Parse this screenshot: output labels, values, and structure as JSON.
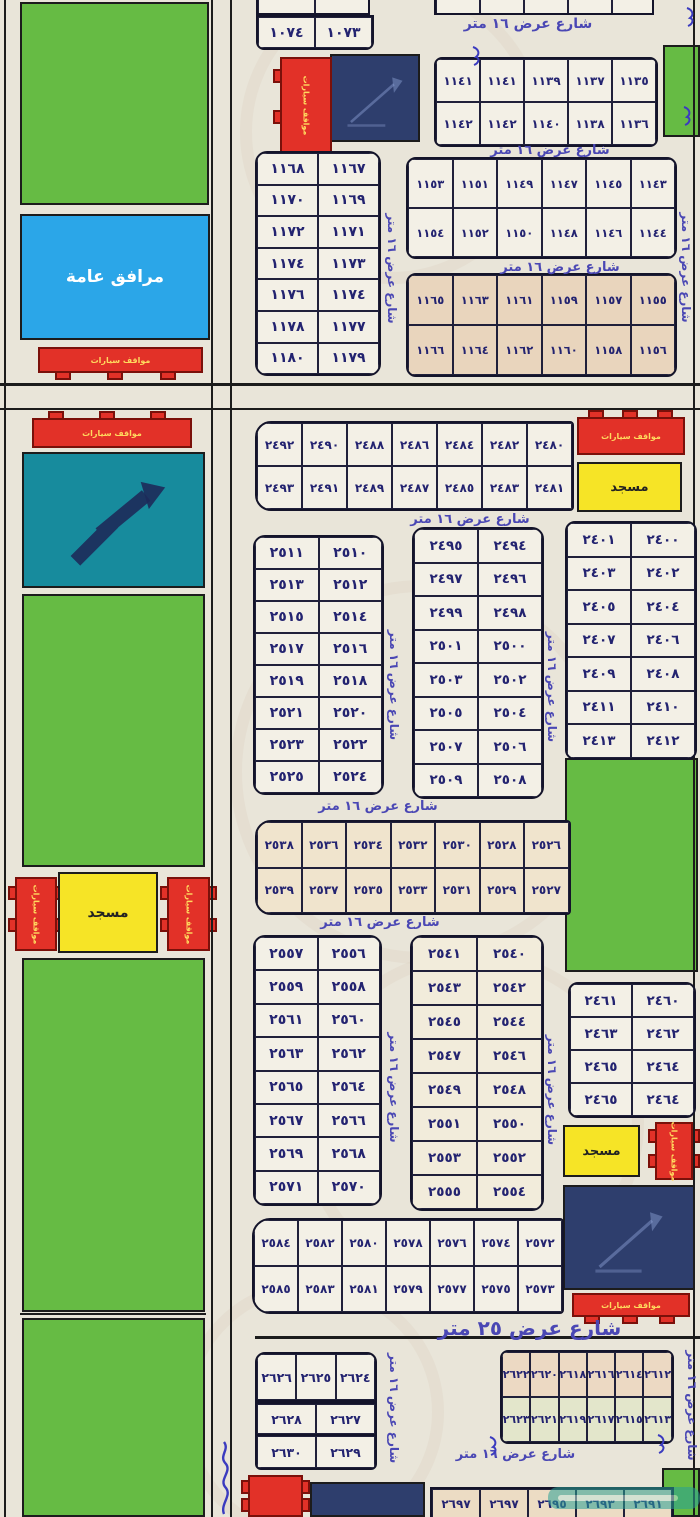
{
  "labels": {
    "street16": "شارع عرض ١٦ متر",
    "street25": "شارع عرض ٢٥ متر",
    "mosque": "مسجد",
    "facilities": "مرافق عامة",
    "parking": "مواقف سيارات"
  },
  "colors": {
    "park_green": "#66bb44",
    "facilities_blue": "#2ba6e8",
    "utility_teal": "#178b9d",
    "reserved_navy": "#2e3e6d",
    "mosque_yellow": "#f6e426",
    "parking_red": "#e23128",
    "street_text": "#4a47b4",
    "plot_number_text": "#232370",
    "paper": "#e9e5d9"
  },
  "tables": {
    "t1073": {
      "rows": [
        [
          "١٠٧٤",
          "١٠٧٣"
        ]
      ]
    },
    "t1135": {
      "rows": [
        [
          "١١٤١",
          "١١٤١",
          "١١٣٩",
          "١١٣٧",
          "١١٣٥"
        ],
        [
          "١١٤٢",
          "١١٤٢",
          "١١٤٠",
          "١١٣٨",
          "١١٣٦"
        ]
      ]
    },
    "t1167": {
      "rows": [
        [
          "١١٦٨",
          "١١٦٧"
        ],
        [
          "١١٧٠",
          "١١٦٩"
        ],
        [
          "١١٧٢",
          "١١٧١"
        ],
        [
          "١١٧٤",
          "١١٧٣"
        ],
        [
          "١١٧٦",
          "١١٧٤"
        ],
        [
          "١١٧٨",
          "١١٧٧"
        ],
        [
          "١١٨٠",
          "١١٧٩"
        ]
      ]
    },
    "t1143": {
      "rows": [
        [
          "١١٥٣",
          "١١٥١",
          "١١٤٩",
          "١١٤٧",
          "١١٤٥",
          "١١٤٣"
        ],
        [
          "١١٥٤",
          "١١٥٢",
          "١١٥٠",
          "١١٤٨",
          "١١٤٦",
          "١١٤٤"
        ]
      ]
    },
    "t1155": {
      "rows": [
        [
          "١١٦٥",
          "١١٦٣",
          "١١٦١",
          "١١٥٩",
          "١١٥٧",
          "١١٥٥"
        ],
        [
          "١١٦٦",
          "١١٦٤",
          "١١٦٢",
          "١١٦٠",
          "١١٥٨",
          "١١٥٦"
        ]
      ]
    },
    "t2480": {
      "rows": [
        [
          "٢٤٩٢",
          "٢٤٩٠",
          "٢٤٨٨",
          "٢٤٨٦",
          "٢٤٨٤",
          "٢٤٨٢",
          "٢٤٨٠"
        ],
        [
          "٢٤٩٣",
          "٢٤٩١",
          "٢٤٨٩",
          "٢٤٨٧",
          "٢٤٨٥",
          "٢٤٨٣",
          "٢٤٨١"
        ]
      ]
    },
    "t2510": {
      "rows": [
        [
          "٢٥١١",
          "٢٥١٠"
        ],
        [
          "٢٥١٣",
          "٢٥١٢"
        ],
        [
          "٢٥١٥",
          "٢٥١٤"
        ],
        [
          "٢٥١٧",
          "٢٥١٦"
        ],
        [
          "٢٥١٩",
          "٢٥١٨"
        ],
        [
          "٢٥٢١",
          "٢٥٢٠"
        ],
        [
          "٢٥٢٣",
          "٢٥٢٢"
        ],
        [
          "٢٥٢٥",
          "٢٥٢٤"
        ]
      ]
    },
    "t2494": {
      "rows": [
        [
          "٢٤٩٥",
          "٢٤٩٤"
        ],
        [
          "٢٤٩٧",
          "٢٤٩٦"
        ],
        [
          "٢٤٩٩",
          "٢٤٩٨"
        ],
        [
          "٢٥٠١",
          "٢٥٠٠"
        ],
        [
          "٢٥٠٣",
          "٢٥٠٢"
        ],
        [
          "٢٥٠٥",
          "٢٥٠٤"
        ],
        [
          "٢٥٠٧",
          "٢٥٠٦"
        ],
        [
          "٢٥٠٩",
          "٢٥٠٨"
        ]
      ]
    },
    "t2400": {
      "rows": [
        [
          "٢٤٠١",
          "٢٤٠٠"
        ],
        [
          "٢٤٠٣",
          "٢٤٠٢"
        ],
        [
          "٢٤٠٥",
          "٢٤٠٤"
        ],
        [
          "٢٤٠٧",
          "٢٤٠٦"
        ],
        [
          "٢٤٠٩",
          "٢٤٠٨"
        ],
        [
          "٢٤١١",
          "٢٤١٠"
        ],
        [
          "٢٤١٣",
          "٢٤١٢"
        ]
      ]
    },
    "t2526": {
      "rows": [
        [
          "٢٥٣٨",
          "٢٥٣٦",
          "٢٥٣٤",
          "٢٥٣٢",
          "٢٥٣٠",
          "٢٥٢٨",
          "٢٥٢٦"
        ],
        [
          "٢٥٣٩",
          "٢٥٣٧",
          "٢٥٣٥",
          "٢٥٣٣",
          "٢٥٣١",
          "٢٥٢٩",
          "٢٥٢٧"
        ]
      ]
    },
    "t2556": {
      "rows": [
        [
          "٢٥٥٧",
          "٢٥٥٦"
        ],
        [
          "٢٥٥٩",
          "٢٥٥٨"
        ],
        [
          "٢٥٦١",
          "٢٥٦٠"
        ],
        [
          "٢٥٦٣",
          "٢٥٦٢"
        ],
        [
          "٢٥٦٥",
          "٢٥٦٤"
        ],
        [
          "٢٥٦٧",
          "٢٥٦٦"
        ],
        [
          "٢٥٦٩",
          "٢٥٦٨"
        ],
        [
          "٢٥٧١",
          "٢٥٧٠"
        ]
      ]
    },
    "t2540": {
      "rows": [
        [
          "٢٥٤١",
          "٢٥٤٠"
        ],
        [
          "٢٥٤٣",
          "٢٥٤٢"
        ],
        [
          "٢٥٤٥",
          "٢٥٤٤"
        ],
        [
          "٢٥٤٧",
          "٢٥٤٦"
        ],
        [
          "٢٥٤٩",
          "٢٥٤٨"
        ],
        [
          "٢٥٥١",
          "٢٥٥٠"
        ],
        [
          "٢٥٥٣",
          "٢٥٥٢"
        ],
        [
          "٢٥٥٥",
          "٢٥٥٤"
        ]
      ]
    },
    "t2460": {
      "rows": [
        [
          "٢٤٦١",
          "٢٤٦٠"
        ],
        [
          "٢٤٦٣",
          "٢٤٦٢"
        ],
        [
          "٢٤٦٥",
          "٢٤٦٤"
        ],
        [
          "٢٤٦٥",
          "٢٤٦٤"
        ]
      ]
    },
    "t2572": {
      "rows": [
        [
          "٢٥٨٤",
          "٢٥٨٢",
          "٢٥٨٠",
          "٢٥٧٨",
          "٢٥٧٦",
          "٢٥٧٤",
          "٢٥٧٢"
        ],
        [
          "٢٥٨٥",
          "٢٥٨٣",
          "٢٥٨١",
          "٢٥٧٩",
          "٢٥٧٧",
          "٢٥٧٥",
          "٢٥٧٣"
        ]
      ]
    },
    "t2624": {
      "rows": [
        [
          "٢٦٢٦",
          "٢٦٢٥",
          "٢٦٢٤"
        ]
      ]
    },
    "t2627": {
      "rows": [
        [
          "٢٦٢٨",
          "٢٦٢٧"
        ]
      ]
    },
    "t2629": {
      "rows": [
        [
          "٢٦٣٠",
          "٢٦٢٩"
        ]
      ]
    },
    "t2612": {
      "rows": [
        [
          "٢٦٢٢",
          "٢٦٢٠",
          "٢٦١٨",
          "٢٦١٦",
          "٢٦١٤",
          "٢٦١٢"
        ],
        [
          "٢٦٢٣",
          "٢٦٢١",
          "٢٦١٩",
          "٢٦١٧",
          "٢٦١٥",
          "٢٦١٣"
        ]
      ]
    },
    "t2691": {
      "rows": [
        [
          "٢٦٩٧",
          "٢٦٩٧",
          "٢٦٩٥",
          "٢٦٩٣",
          "٢٦٩١"
        ]
      ]
    }
  }
}
